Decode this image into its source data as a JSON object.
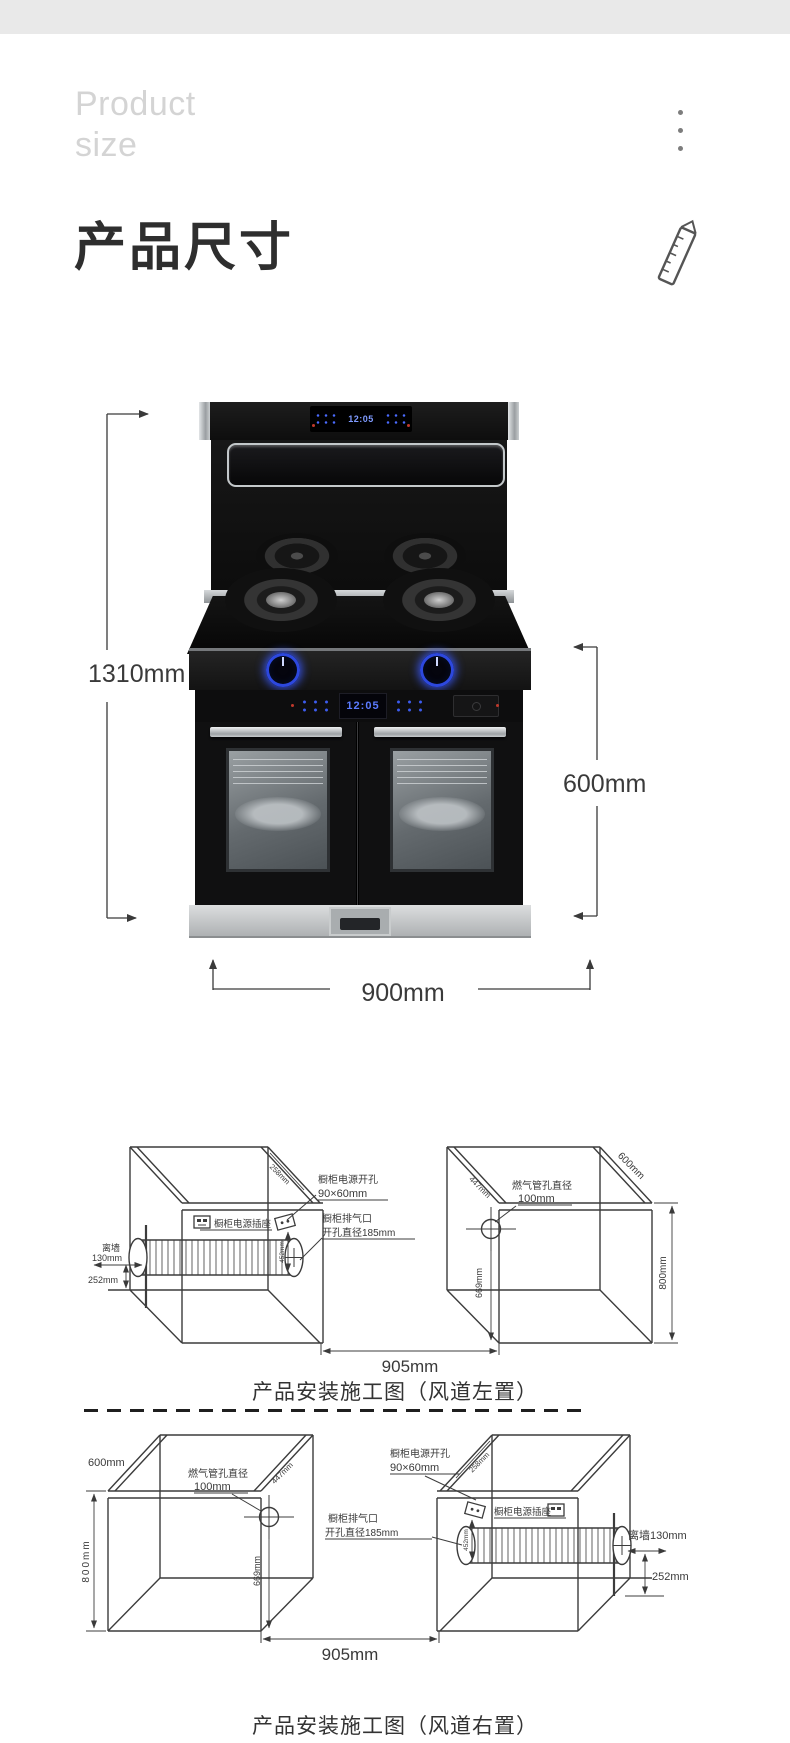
{
  "header": {
    "eyebrow_line1": "Product",
    "eyebrow_line2": "size",
    "title": "产品尺寸"
  },
  "colors": {
    "accent_blue": "#2d48de",
    "topbar_gray": "#e9e9e9",
    "line_dark": "#3a3a3a"
  },
  "product": {
    "clock": "12:05",
    "dim_height": "1310mm",
    "dim_front_height": "600mm",
    "dim_width": "900mm"
  },
  "diagram_left": {
    "caption": "产品安装施工图（风道左置）",
    "gap": "905mm",
    "wall_line1": "离墙",
    "wall_line2": "130mm",
    "floor_offset": "252mm",
    "socket_label": "橱柜电源插座",
    "power_hole_line1": "橱柜电源开孔",
    "power_hole_line2": "90×60mm",
    "power_hole_offset": "258mm",
    "vent_line1": "橱柜排气口",
    "vent_line2": "开孔直径185mm",
    "vent_drop": "452mm",
    "gas_line1": "燃气管孔直径",
    "gas_line2": "100mm",
    "gas_height": "669mm",
    "depth_447": "447mm",
    "depth_600": "600mm",
    "cabinet_height": "800mm"
  },
  "diagram_right": {
    "caption": "产品安装施工图（风道右置）",
    "gap": "905mm",
    "wall_label": "离墙130mm",
    "floor_offset": "252mm",
    "socket_label": "橱柜电源插座",
    "power_hole_line1": "橱柜电源开孔",
    "power_hole_line2": "90×60mm",
    "power_hole_offset": "258mm",
    "vent_line1": "橱柜排气口",
    "vent_line2": "开孔直径185mm",
    "vent_drop": "452mm",
    "gas_line1": "燃气管孔直径",
    "gas_line2": "100mm",
    "gas_height": "669mm",
    "depth_447": "447mm",
    "depth_600": "600mm",
    "cabinet_height": "800mm"
  }
}
